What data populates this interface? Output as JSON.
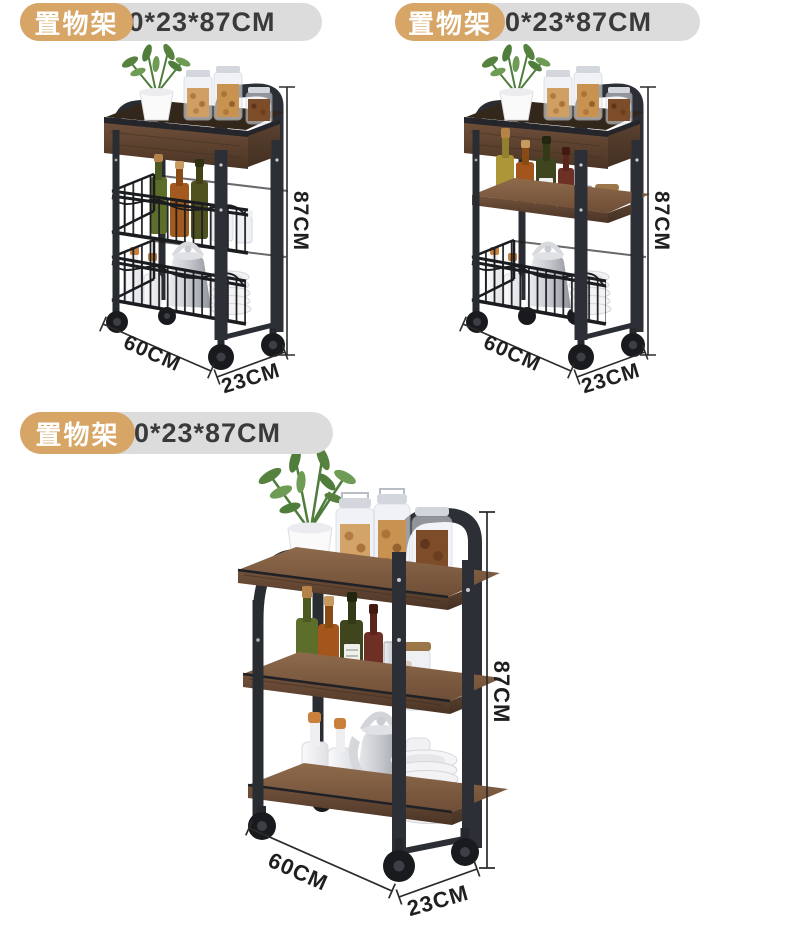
{
  "colors": {
    "badge_tan": "#d7a565",
    "badge_gray": "#dcdcdc",
    "badge_text": "#ffffff",
    "size_text": "#3a3a3a",
    "dim_text": "#1f1f1f",
    "frame_black": "#2b2e34",
    "wood_brown": "#5f4433"
  },
  "products": [
    {
      "variant": "slim 3-tier cart, wood top tray + two wire mesh baskets",
      "badge": {
        "label": "置物架",
        "size": "60*23*87CM"
      },
      "dimensions": {
        "height": "87CM",
        "width": "60CM",
        "depth": "23CM"
      }
    },
    {
      "variant": "slim 3-tier cart, wood top tray + wood middle shelf + wire basket",
      "badge": {
        "label": "置物架",
        "size": "60*23*87CM"
      },
      "dimensions": {
        "height": "87CM",
        "width": "60CM",
        "depth": "23CM"
      }
    },
    {
      "variant": "slim 3-tier cart, three flat wood shelves",
      "badge": {
        "label": "置物架",
        "size": "60*23*87CM"
      },
      "dimensions": {
        "height": "87CM",
        "width": "60CM",
        "depth": "23CM"
      }
    }
  ]
}
